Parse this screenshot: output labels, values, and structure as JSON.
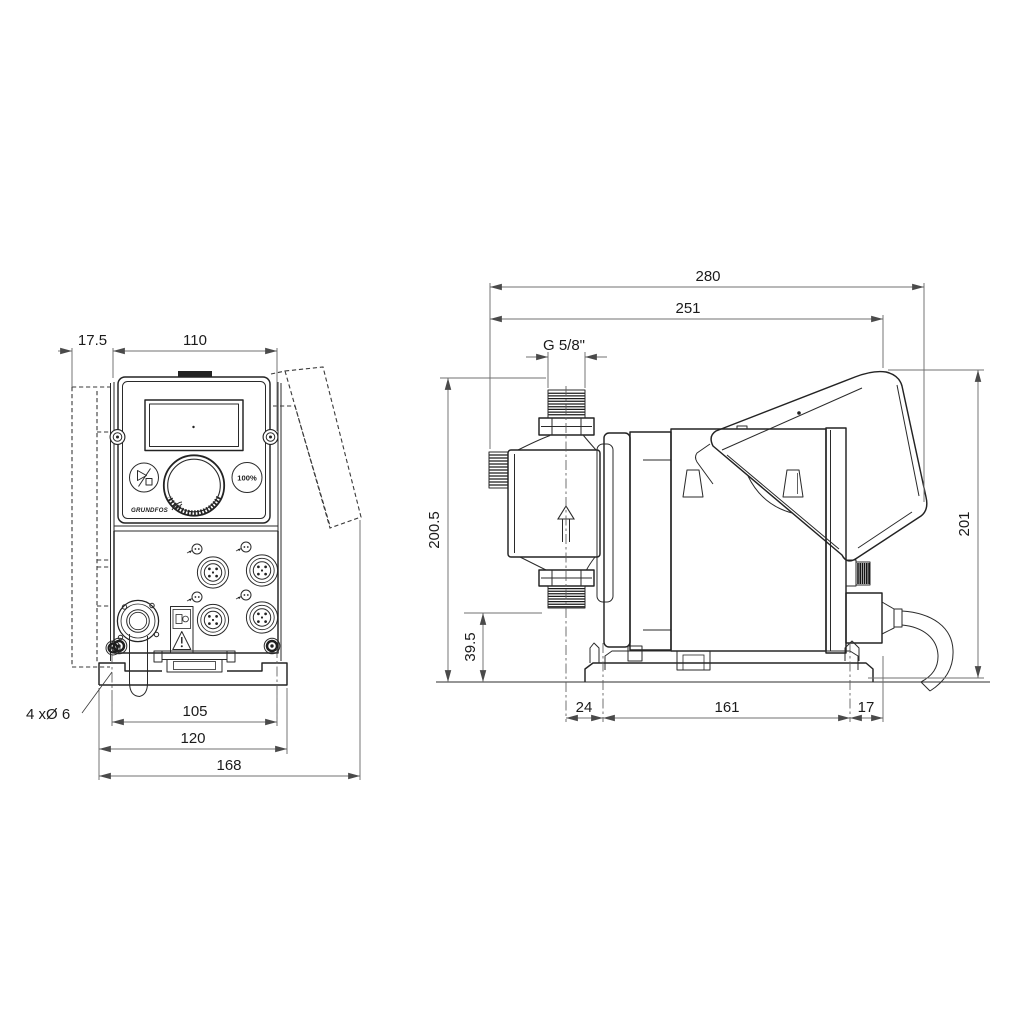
{
  "front_view": {
    "dims": {
      "offset_depth": "17.5",
      "panel_width": "110",
      "hole_spacing": "105",
      "base_width": "120",
      "overall_width": "168"
    },
    "mounting_holes_note": "4 xØ 6",
    "control_panel": {
      "logo": "GRUNDFOS",
      "capacity_button": "100%"
    }
  },
  "side_view": {
    "dims": {
      "overall_depth": "280",
      "body_depth": "251",
      "connection_thread": "G 5/8\"",
      "total_height": "200.5",
      "valve_height": "39.5",
      "front_hole_offset": "24",
      "hole_spacing": "161",
      "rear_hole_offset": "17",
      "body_height": "201"
    }
  },
  "colors": {
    "line": "#232323",
    "dim_line": "#707070",
    "text": "#1b1b1b",
    "background": "#ffffff"
  }
}
